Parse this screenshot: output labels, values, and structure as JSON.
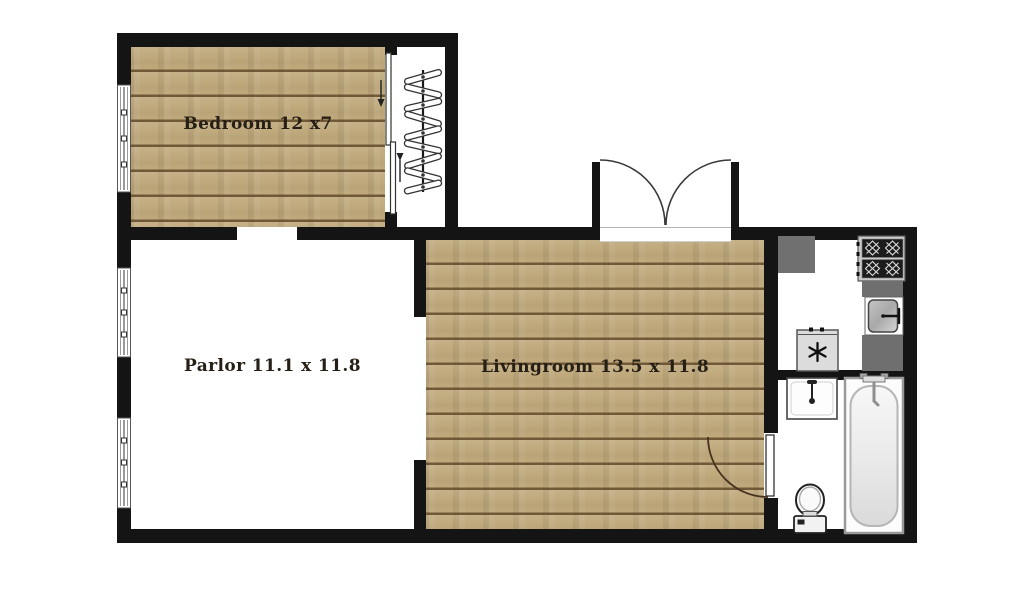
{
  "plan": {
    "type": "apartment-floorplan",
    "rooms": {
      "bedroom": {
        "label": "Bedroom 12 x7"
      },
      "parlor": {
        "label": "Parlor 11.1 x 11.8"
      },
      "livingroom": {
        "label": "Livingroom 13.5 x 11.8"
      }
    },
    "fixtures": {
      "closet": [
        "clothes-rail",
        "hangers"
      ],
      "kitchen": [
        "corner-counter-block",
        "range-4-burner",
        "kitchen-sink",
        "counters",
        "appliance-asterisk"
      ],
      "bathroom": [
        "bathroom-sink",
        "toilet",
        "bathtub"
      ],
      "doors": [
        "entry-double-swing-door",
        "closet-bypass-sliding-door",
        "bathroom-hinged-door"
      ],
      "windows_count": 3
    },
    "colors": {
      "wall": "#141414",
      "wood_floor": "#bfa97c",
      "wood_plank_line": "#634a2b",
      "counter_gray": "#6f6f6f",
      "background": "#ffffff",
      "label_text": "#261f15"
    }
  }
}
